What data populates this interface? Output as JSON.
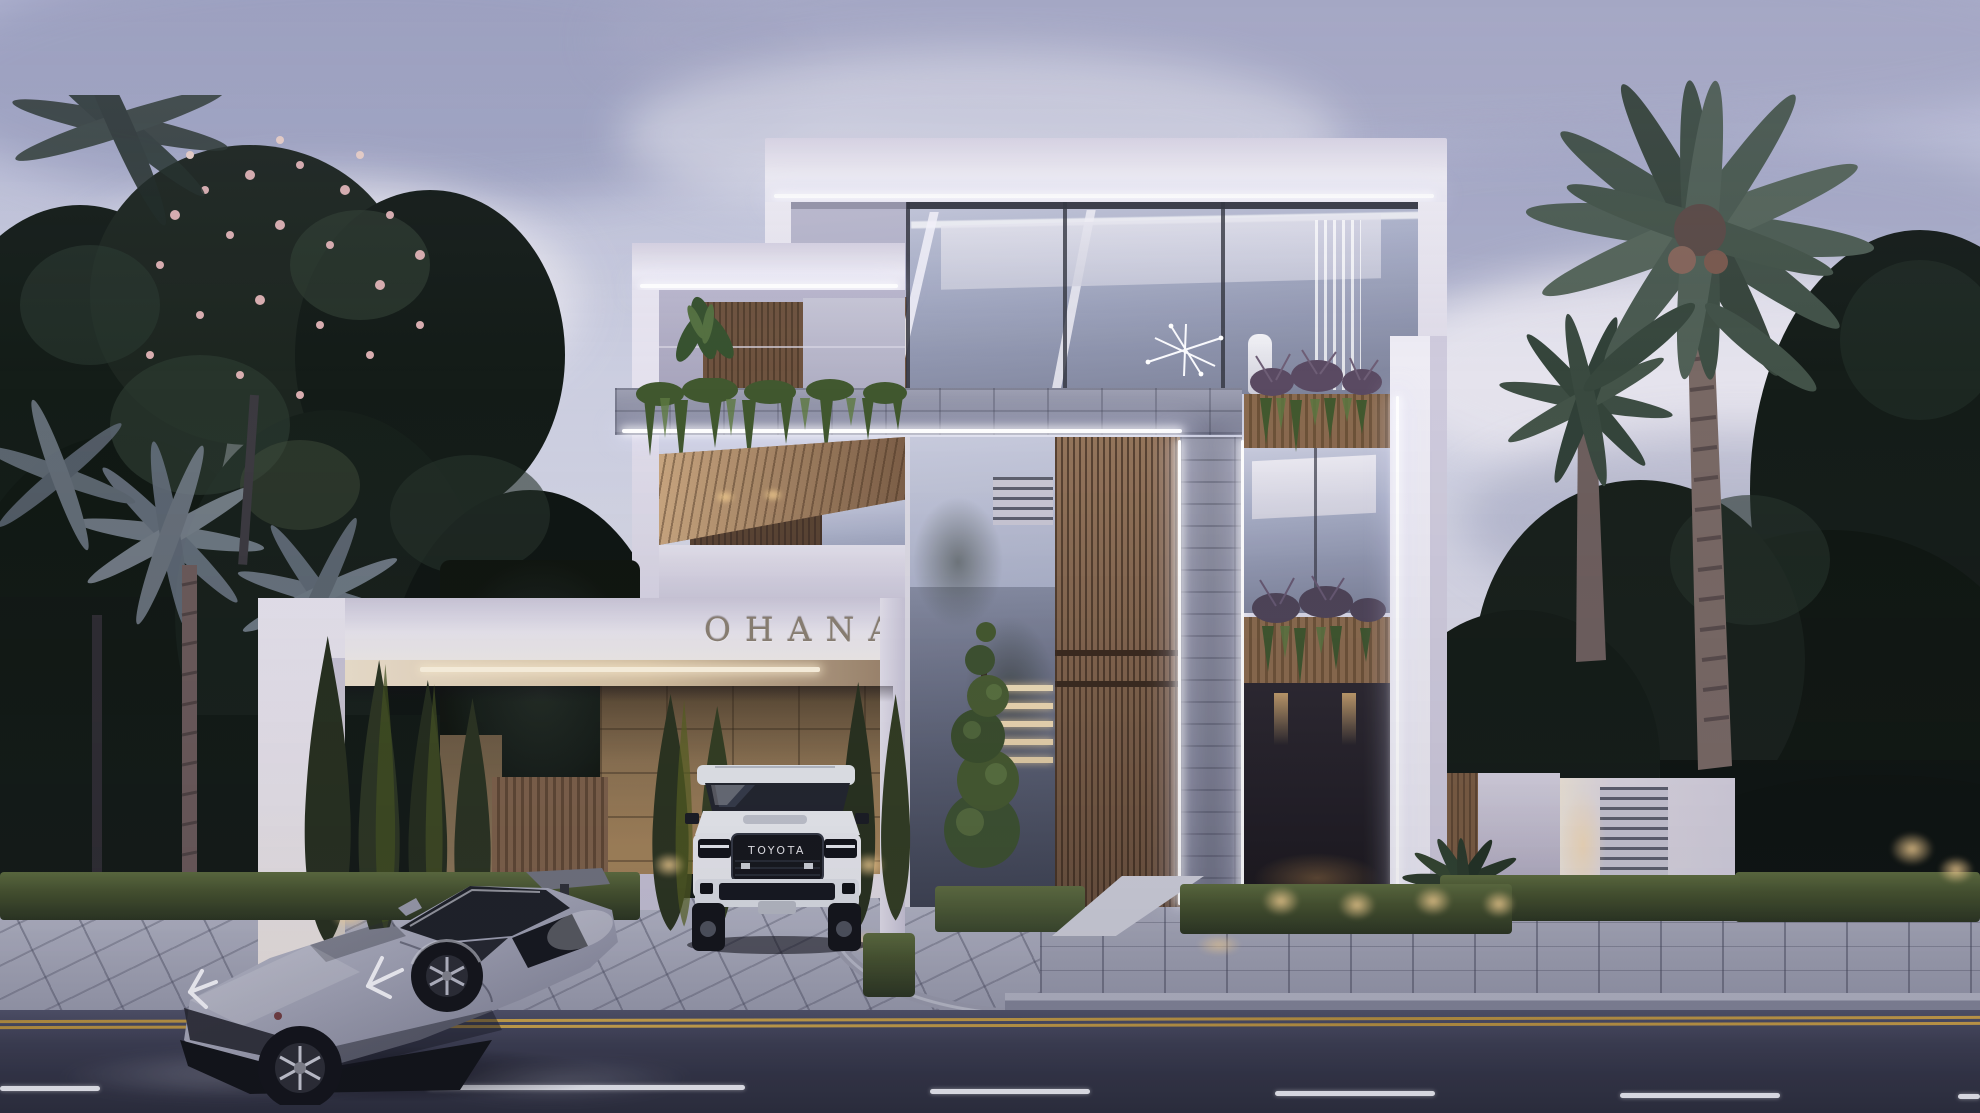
{
  "scene": {
    "description": "Twilight photorealistic rendering of a modern three-storey luxury villa with LED-lit white fascias, wood slat panels, stone cladding, landscaped entrance gate, a white SUV parked in the driveway and a silver supercar on the street",
    "sign": {
      "text": "OHANA"
    },
    "vehicles": {
      "suv": {
        "badge": "TOYOTA",
        "body_color": "#edeff3"
      },
      "supercar": {
        "body_color": "#a6a8b9"
      }
    },
    "colors": {
      "sky_top": "#b6b9d6",
      "sky_mid": "#d2d4e4",
      "sky_low": "#e6e0e8",
      "foliage_dark": "#161f1a",
      "foliage_light": "#33402f",
      "blossom_pink": "#d9aeb0",
      "wall_white": "#efedf4",
      "wall_shade": "#bcb8cf",
      "led_white": "#ffffff",
      "wood": "#8a6a50",
      "wood_dark": "#5e4634",
      "stone_gray": "#8f92a6",
      "stone_tan": "#8d7352",
      "glass_blue": "#a9afc7",
      "hedge_green": "#3c4a2e",
      "grass_green": "#4a5632",
      "paver_gray": "#a9abbb",
      "road_asphalt": "#383a4a",
      "lane_yellow": "#c49c48",
      "lane_white": "#eef0f6",
      "warm_light": "#e8c27c"
    }
  }
}
